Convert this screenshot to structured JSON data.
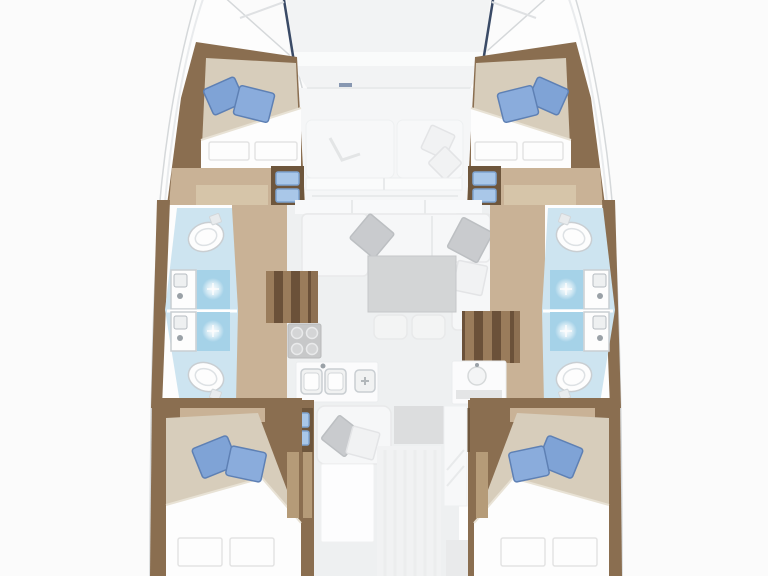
{
  "title": "Catamaran interior floor plan (top-down deck layout)",
  "vessel": {
    "type": "sailing catamaran",
    "view": "top-down interior layout, bow at top",
    "cabins": 4,
    "double_berths": 4,
    "heads_compartments": 2,
    "showers": 4,
    "toilets": 4,
    "companionway_stairs": 2
  },
  "rooms": {
    "bow_deck": {
      "name": "foredeck between bows"
    },
    "forward_cockpit": {
      "name": "forward cockpit",
      "features": [
        "two bench cushions",
        "scatter pillows"
      ]
    },
    "forward_cabin_port": {
      "name": "forward cabin port",
      "features": [
        "double berth",
        "2 blue pillows",
        "2 white pillows",
        "drawer cabinet"
      ]
    },
    "forward_cabin_starboard": {
      "name": "forward cabin starboard",
      "features": [
        "double berth",
        "2 blue pillows",
        "2 white pillows",
        "drawer cabinet"
      ]
    },
    "head_port": {
      "name": "port hull head / bathroom",
      "features": [
        "2 toilets",
        "2 washbasins",
        "2 showers"
      ]
    },
    "head_starboard": {
      "name": "starboard hull head / bathroom",
      "features": [
        "2 toilets",
        "2 washbasins",
        "2 showers"
      ]
    },
    "salon": {
      "name": "salon",
      "features": [
        "L-shaped sofa",
        "gray table",
        "2 stools",
        "gray cushions"
      ]
    },
    "galley": {
      "name": "galley",
      "features": [
        "4-burner stove",
        "double sink",
        "prep sink",
        "counter with round sink"
      ]
    },
    "aft_lounge": {
      "name": "aft seat and chart area",
      "features": [
        "settee with cushions",
        "gray block",
        "white berth panel"
      ]
    },
    "aft_cabin_port": {
      "name": "aft cabin port",
      "features": [
        "double berth",
        "2 blue pillows",
        "2 white pillows",
        "drawer cabinet"
      ]
    },
    "aft_cabin_starboard": {
      "name": "aft cabin starboard",
      "features": [
        "double berth",
        "2 blue pillows",
        "2 white pillows",
        "drawer cabinet"
      ]
    }
  },
  "colors": {
    "bg": "#fbfbfb",
    "hull-fill": "#fdfdfd",
    "hull-stroke": "#d5d8da",
    "hull-line": "#e9ebed",
    "deck": "#f2f3f4",
    "deck-band": "#fafbfb",
    "navy": "#3a4a66",
    "bow-line": "#dfe1e3",
    "wood-dark": "#8a6e50",
    "wood-darker": "#6e563c",
    "wood-mid": "#b59b78",
    "wood-light": "#c9b296",
    "wood-floor": "#d6c5a9",
    "stair-a": "#9a7c5b",
    "stair-b": "#6b5139",
    "duvet": "#d7cdbb",
    "duvet-edge": "#e8e2d5",
    "white": "#fdfdfd",
    "pillow-white-stroke": "#e3e3e3",
    "pillow-blue": "#7fa3d6",
    "pillow-blue2": "#8aacdc",
    "pillow-blue-dark": "#5e80b4",
    "pillow-gray": "#c9cbce",
    "pillow-gray-stroke": "#bcbfc2",
    "pillow-pale": "#f1f2f3",
    "pillow-pale-stroke": "#e3e4e6",
    "bath-floor": "#cde4f0",
    "shower-blue": "#a5d2e8",
    "fixture-stroke": "#c9ced2",
    "fixture-detail": "#9aa1a7",
    "salon-floor": "#eef0f1",
    "sofa": "#f6f7f8",
    "sofa-stroke": "#e8e9ea",
    "seam": "#e8eaeb",
    "table-gray": "#d3d5d6",
    "table-stroke": "#c5c7c9",
    "stool": "#f3f4f4",
    "stove": "#c7c8c9",
    "stove-stroke": "#b9babb",
    "burner": "#d4d5d6",
    "burner-ring": "#e9eaeb",
    "counter": "#fbfbfc",
    "counter-stroke": "#ebedee",
    "sink-basin": "#f1f2f2",
    "sink-inner-stroke": "#d4d7d9",
    "drawer-blue": "#a9c7e8",
    "drawer-stroke": "#7ea3cf",
    "gray-block": "#dcddde",
    "pale-panel": "#f7f8f9",
    "pale-panel-stroke": "#eef0f1",
    "stripe": "#eaebec"
  }
}
